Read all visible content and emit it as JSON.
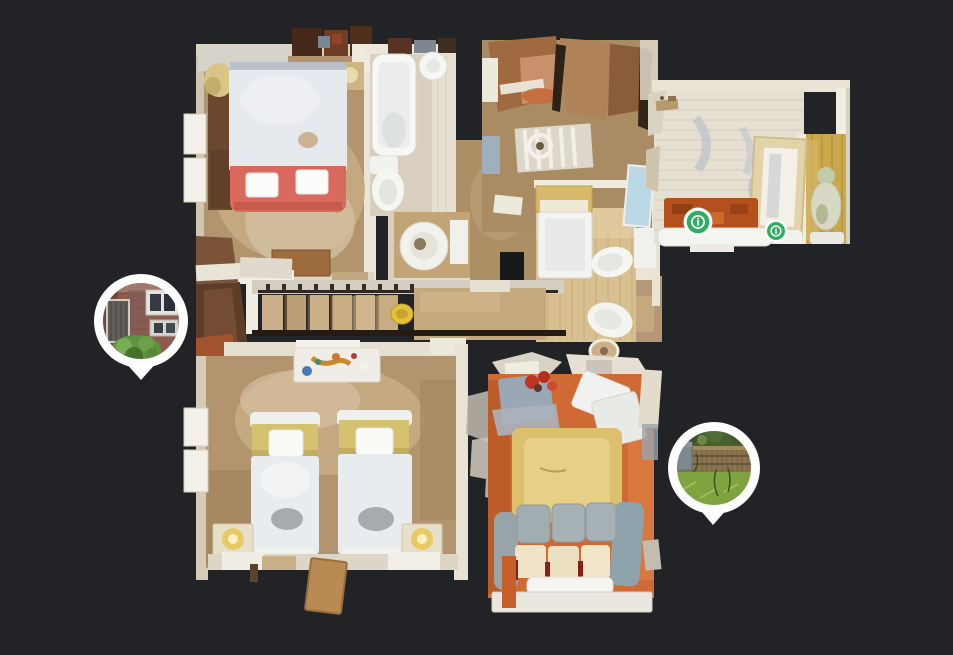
{
  "view": {
    "type": "3d-dollhouse-floor-plan",
    "background_color": "#212326"
  },
  "colors": {
    "background": "#212326",
    "pin_white": "#ffffff",
    "marker_green": "#2fae62",
    "wall_cream": "#e8e3d5",
    "carpet_tan": "#b2946f",
    "bathroom_floor": "#d8cfbf",
    "wood_light": "#d9c091",
    "plank_white": "#e6e0d2",
    "pine_yellow": "#c9a84e",
    "terracotta_orange": "#cf6a34",
    "rug_sand": "#ddc06e",
    "rug_rust": "#b3501e",
    "bed_throw_red": "#d9695c",
    "twin_bed_band_yellow": "#d4c270",
    "sofa_gray": "#a0aeb2",
    "stair_wood": "#ccb089"
  },
  "info_markers": [
    {
      "symbol": "i"
    },
    {
      "symbol": "i"
    }
  ],
  "photo_pins": [
    {
      "content": "house-entrance-photo"
    },
    {
      "content": "garden-photo"
    }
  ],
  "rooms": [
    {
      "name": "master-bedroom"
    },
    {
      "name": "main-bathroom"
    },
    {
      "name": "shower-room"
    },
    {
      "name": "landing-study"
    },
    {
      "name": "ensuite-bathroom"
    },
    {
      "name": "attic-bedroom"
    },
    {
      "name": "staircase-hall"
    },
    {
      "name": "twin-bedroom"
    },
    {
      "name": "living-room"
    }
  ]
}
